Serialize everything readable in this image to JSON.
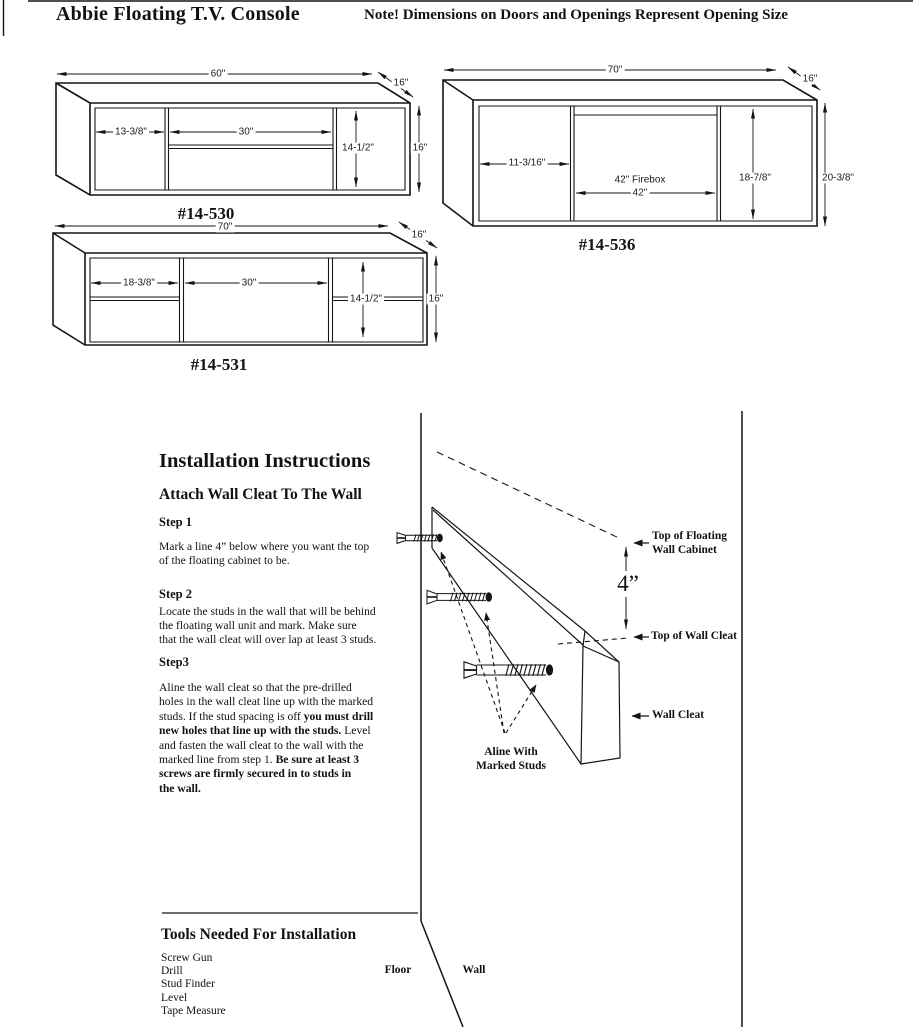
{
  "header": {
    "title": "Abbie Floating T.V. Console",
    "note": "Note! Dimensions on Doors and Openings Represent Opening Size"
  },
  "drawings": {
    "d530": {
      "label": "#14-530",
      "width": "60\"",
      "depth": "16\"",
      "height": "16\"",
      "left_opening": "13-3/8\"",
      "center_opening": "30\"",
      "opening_height": "14-1/2\""
    },
    "d536": {
      "label": "#14-536",
      "width": "70\"",
      "depth": "16\"",
      "height": "20-3/8\"",
      "left_opening": "11-3/16\"",
      "firebox_label": "42\" Firebox",
      "firebox_width": "42\"",
      "opening_height": "18-7/8\""
    },
    "d531": {
      "label": "#14-531",
      "width": "70\"",
      "depth": "16\"",
      "height": "16\"",
      "left_opening": "18-3/8\"",
      "center_opening": "30\"",
      "opening_height": "14-1/2\""
    }
  },
  "instructions": {
    "title": "Installation Instructions",
    "subtitle": "Attach Wall Cleat To The Wall",
    "step1_heading": "Step 1",
    "step1_body": "Mark a line 4” below where you want the top\nof the floating cabinet to be.",
    "step2_heading": "Step 2",
    "step2_body": "Locate the studs in the wall that will be behind\nthe floating wall unit and mark. Make sure\nthat the wall cleat will over lap at least 3 studs.",
    "step3_heading": "Step3",
    "step3_body_a": "Aline the wall cleat so that the pre-drilled\nholes in the wall cleat line up with the marked\nstuds. If the stud spacing is off ",
    "step3_body_b": "you must drill\nnew holes that line up with the studs.",
    "step3_body_c": " Level\nand fasten the wall cleat to the wall with the\nmarked line from step 1. ",
    "step3_body_d": "Be sure at least 3\nscrews are firmly secured in to studs in\nthe wall."
  },
  "diagram": {
    "offset_dim": "4”",
    "top_cabinet_label": "Top of Floating\nWall Cabinet",
    "top_cleat_label": "Top of Wall Cleat",
    "cleat_label": "Wall Cleat",
    "aline_label": "Aline With\nMarked Studs",
    "floor_label": "Floor",
    "wall_label": "Wall"
  },
  "tools": {
    "title": "Tools Needed For Installation",
    "items": [
      "Screw Gun",
      "Drill",
      "Stud Finder",
      "Level",
      "Tape Measure"
    ]
  }
}
